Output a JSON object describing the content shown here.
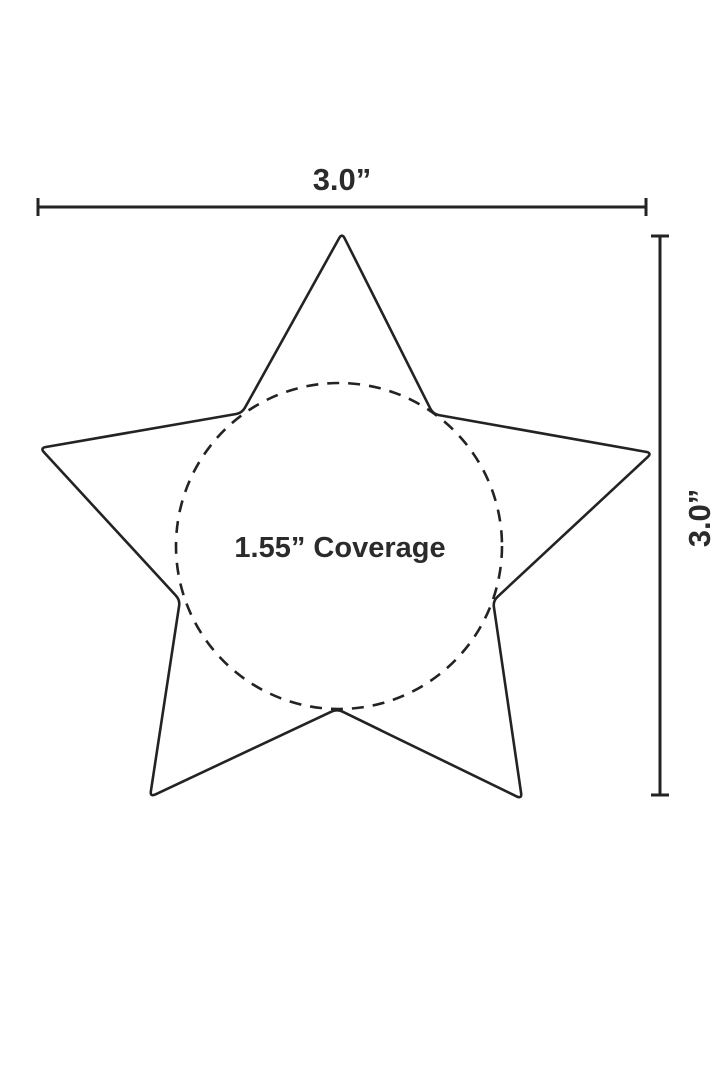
{
  "page": {
    "background_color": "#ffffff"
  },
  "diagram": {
    "description": "Dimension drawing of a five-pointed star with dashed coverage circle",
    "stroke_color": "#232323",
    "text_color": "#2b2b2b",
    "width_label": "3.0”",
    "height_label": "3.0”",
    "coverage_label": "1.55” Coverage",
    "star": {
      "points": [
        [
          342,
          233
        ],
        [
          433,
          414
        ],
        [
          652,
          453
        ],
        [
          493,
          601
        ],
        [
          522,
          799
        ],
        [
          337,
          709
        ],
        [
          150,
          797
        ],
        [
          180,
          600
        ],
        [
          40,
          448
        ],
        [
          242,
          413
        ]
      ],
      "corner_radius": 6,
      "stroke_width": 2.6
    },
    "coverage_circle": {
      "cx": 339,
      "cy": 546,
      "r": 163,
      "stroke_width": 2.6,
      "dash": "12 9"
    },
    "width_dimension": {
      "y": 207,
      "x1": 38,
      "x2": 646,
      "cap_half": 9,
      "stroke_width": 3
    },
    "height_dimension": {
      "x": 660,
      "y1": 236,
      "y2": 795,
      "cap_half": 9,
      "stroke_width": 3
    }
  }
}
